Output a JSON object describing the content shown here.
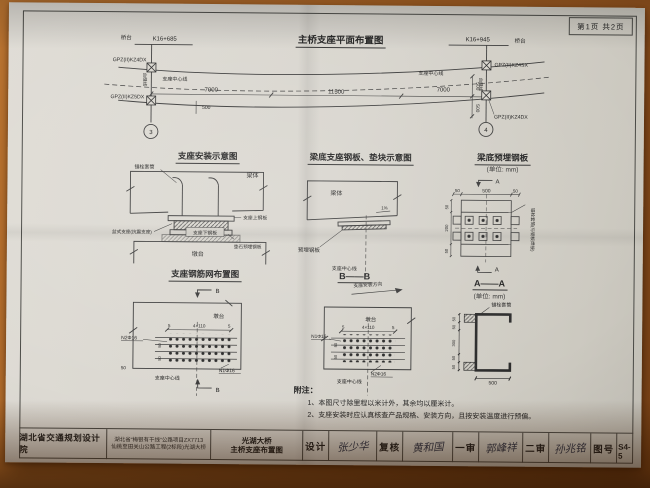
{
  "page": {
    "sheet_label": "第1页 共2页"
  },
  "plan": {
    "title": "主桥支座平面布置图",
    "abutment_left": "桥台",
    "station_left": "K16+685",
    "station_right": "K16+945",
    "abutment_right": "桥台",
    "joint_left": "台缝线",
    "joint_right": "台缝线",
    "bearing_centerline_left": "支座中心线",
    "bearing_centerline_right": "支座中心线",
    "bearing_top_left": "GPZ(II)KZ4DX",
    "bearing_bottom_left": "GPZ(II)KZ5DX",
    "bearing_top_right": "GPZ(II)KZ4SX",
    "bearing_bottom_right": "GPZ(II)KZ4DX",
    "dim_span_left": "7000",
    "dim_span_mid": "11500",
    "dim_span_right": "7000",
    "dim_offset_left": "500",
    "dim_offset_right_1": "500",
    "dim_offset_right_2": "500",
    "axis_left": "3",
    "axis_right": "4"
  },
  "install": {
    "title": "支座安装示意图",
    "anchor_sleeve": "锚栓套筒",
    "beam": "梁体",
    "top_plate": "支座上钢板",
    "pot_bearing": "盆式支座(抗震支座)",
    "bottom_plate": "支座下钢板",
    "pad_plate": "垫石预埋钢板",
    "pier": "墩台"
  },
  "beam_plate": {
    "title": "梁底支座钢板、垫块示意图",
    "beam": "梁体",
    "slope": "1%",
    "embed_plate": "预埋钢板",
    "centerline": "支座中心线"
  },
  "embed": {
    "title": "梁底预埋钢板",
    "unit": "(单位: mm)",
    "mark_top": "A",
    "mark_bottom": "A",
    "dim_top_left": "50",
    "dim_top_mid": "500",
    "dim_top_right": "50",
    "dim_left_1": "50",
    "dim_left_2": "200",
    "dim_left_3": "50",
    "side_note": "锚栓套筒(与钢板焊接)"
  },
  "mesh_plan": {
    "title": "支座钢筋网布置图",
    "mark_top": "B",
    "mark_bottom": "B",
    "pier": "墩台",
    "dim_a": "5",
    "dim_b": "4×110",
    "dim_c": "5",
    "bar_n2": "N2Φ16",
    "bar_n1": "N1Φ16",
    "dim_s1": "50",
    "dim_s2": "50",
    "dim_s3": "50",
    "centerline": "支座中心线"
  },
  "mesh_section": {
    "title": "B——B",
    "direction": "支座安装方向",
    "pier": "墩台",
    "dim_a": "5",
    "dim_b": "4×110",
    "dim_c": "5",
    "bar_n1": "N1Φ16",
    "bar_n2": "N2Φ16",
    "dim_s1": "50",
    "dim_s2": "50",
    "centerline": "支座中心线"
  },
  "section_aa": {
    "title": "A——A",
    "unit": "(单位: mm)",
    "anchor": "锚栓套筒",
    "dim_1": "50",
    "dim_2": "50",
    "dim_mid": "300",
    "dim_3": "50",
    "dim_4": "50",
    "dim_width": "500"
  },
  "notes": {
    "heading": "附注：",
    "item_1": "1、本图尺寸除里程以米计外，其余均以厘米计。",
    "item_2": "2、支座安装时应认真核查产品规格、安装方向，且按安装温度进行预偏。"
  },
  "titleblock": {
    "institute": "湖北省交通规划设计院",
    "project_line1": "湖北省“梅银有干线”公路项目ZX7713",
    "project_line2": "仙桃至田关山公路工程(2标段)光湖大桥",
    "bridge": "光湖大桥",
    "drawing": "主桥支座布置图",
    "design_label": "设计",
    "design_sig": "张少华",
    "check_label": "复核",
    "check_sig": "黄和国",
    "review1_label": "一审",
    "review1_sig": "郭峰祥",
    "review2_label": "二审",
    "review2_sig": "孙兆铭",
    "no_label": "图号",
    "no_value": "S4-5"
  }
}
